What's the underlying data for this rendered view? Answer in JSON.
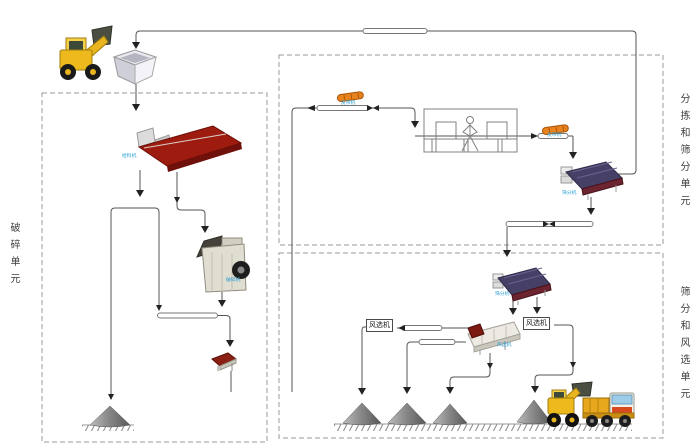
{
  "diagram": {
    "units": {
      "crushing": "破碎单元",
      "sorting_screening": "分拣和筛分单元",
      "screening_air": "筛分和风选单元"
    },
    "equipment_labels": {
      "air_separator_1": "风选机",
      "air_separator_2": "风选机",
      "feeder": "给料机",
      "crusher": "破碎机",
      "belt_1": "皮带机",
      "belt_2": "皮带机",
      "screen_1": "筛分机",
      "screen_2": "筛分机",
      "air_conveyor": "风选机"
    },
    "colors": {
      "line": "#555555",
      "dashed_border": "#9a9a9a",
      "feeder_red": "#9e1b10",
      "screen_navy": "#474066",
      "conveyor_orange": "#e8821c",
      "vehicle_yellow": "#edb91c",
      "pile_gray": "#8a8a8a",
      "label_blue": "#2a9fd4"
    }
  }
}
